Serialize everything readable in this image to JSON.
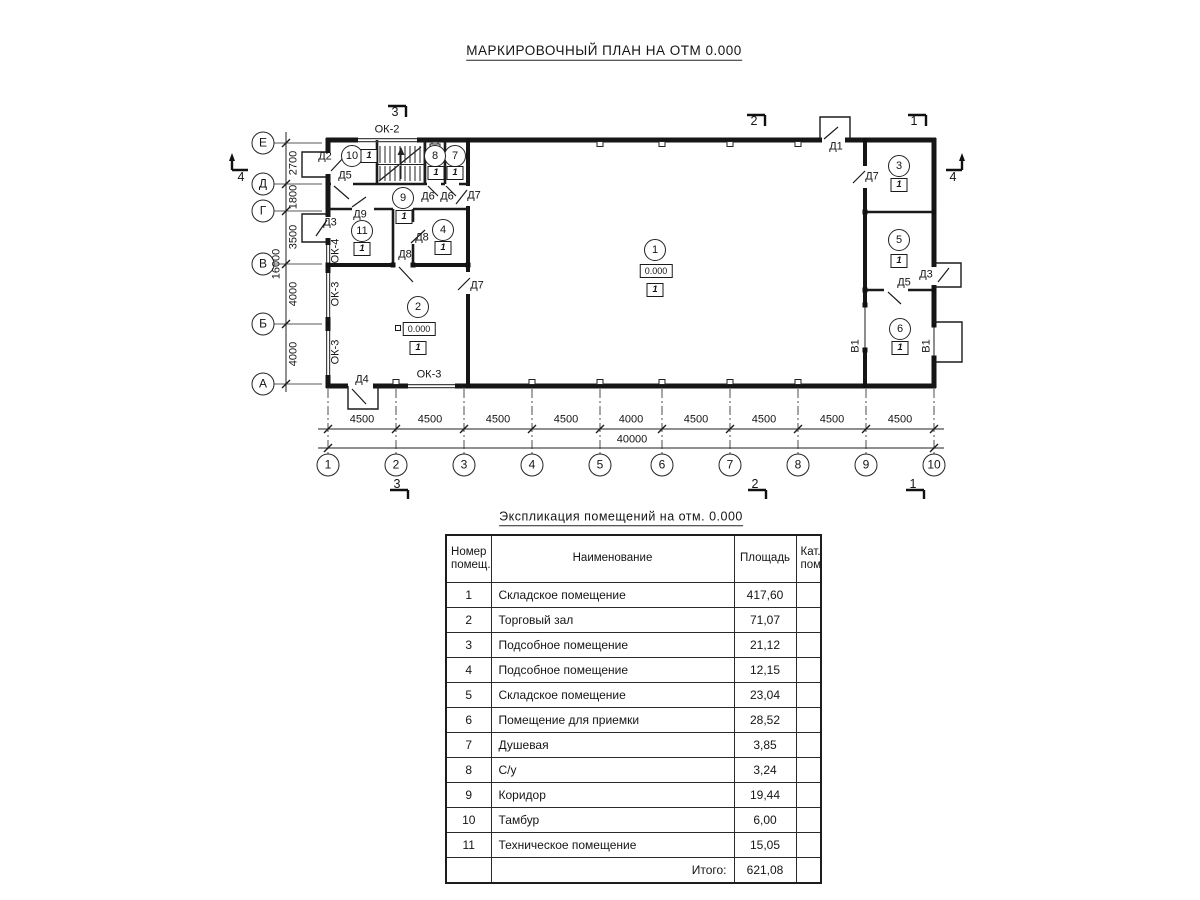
{
  "titles": {
    "plan": "МАРКИРОВОЧНЫЙ ПЛАН НА ОТМ 0.000",
    "table": "Экспликация помещений на отм. 0.000"
  },
  "axes": {
    "cols": [
      "1",
      "2",
      "3",
      "4",
      "5",
      "6",
      "7",
      "8",
      "9",
      "10"
    ],
    "rows": [
      "Е",
      "Д",
      "Г",
      "В",
      "Б",
      "А"
    ]
  },
  "dims": {
    "col_segments": [
      "4500",
      "4500",
      "4500",
      "4500",
      "4000",
      "4500",
      "4500",
      "4500",
      "4500"
    ],
    "col_total": "40000",
    "row_segments": [
      "2700",
      "1800",
      "3500",
      "4000",
      "4000"
    ],
    "row_total": "16000"
  },
  "sections": {
    "top": [
      "3",
      "2",
      "1"
    ],
    "bottom": [
      "3",
      "2",
      "1"
    ],
    "left": "4",
    "right": "4"
  },
  "doors": [
    "Д2",
    "Д5",
    "Д9",
    "Д3",
    "Д8",
    "Д8",
    "Д7",
    "Д4",
    "Д6",
    "Д6",
    "Д7",
    "Д1",
    "Д7",
    "Д3",
    "Д5"
  ],
  "gates": [
    "В1",
    "В1"
  ],
  "windows": [
    "ОК-2",
    "ОК-4",
    "ОК-3",
    "ОК-3",
    "ОК-3"
  ],
  "rooms": [
    {
      "num": "1",
      "marker": "1",
      "elevation": "0.000"
    },
    {
      "num": "2",
      "marker": "1",
      "elevation": "0.000"
    },
    {
      "num": "3",
      "marker": "1"
    },
    {
      "num": "4",
      "marker": "1"
    },
    {
      "num": "5",
      "marker": "1"
    },
    {
      "num": "6",
      "marker": "1"
    },
    {
      "num": "7",
      "marker": "1"
    },
    {
      "num": "8",
      "marker": "1"
    },
    {
      "num": "9",
      "marker": "1"
    },
    {
      "num": "10",
      "marker": "1"
    },
    {
      "num": "11",
      "marker": "1"
    }
  ],
  "table": {
    "headers": {
      "num": "Номер помещ.",
      "name": "Наименование",
      "area": "Площадь",
      "cat": "Кат. пом."
    },
    "rows": [
      {
        "num": "1",
        "name": "Складское помещение",
        "area": "417,60",
        "cat": ""
      },
      {
        "num": "2",
        "name": "Торговый зал",
        "area": "71,07",
        "cat": ""
      },
      {
        "num": "3",
        "name": "Подсобное помещение",
        "area": "21,12",
        "cat": ""
      },
      {
        "num": "4",
        "name": "Подсобное помещение",
        "area": "12,15",
        "cat": ""
      },
      {
        "num": "5",
        "name": "Складское помещение",
        "area": "23,04",
        "cat": ""
      },
      {
        "num": "6",
        "name": "Помещение для приемки",
        "area": "28,52",
        "cat": ""
      },
      {
        "num": "7",
        "name": "Душевая",
        "area": "3,85",
        "cat": ""
      },
      {
        "num": "8",
        "name": "С/у",
        "area": "3,24",
        "cat": ""
      },
      {
        "num": "9",
        "name": "Коридор",
        "area": "19,44",
        "cat": ""
      },
      {
        "num": "10",
        "name": "Тамбур",
        "area": "6,00",
        "cat": ""
      },
      {
        "num": "11",
        "name": "Техническое помещение",
        "area": "15,05",
        "cat": ""
      }
    ],
    "total_label": "Итого:",
    "total_area": "621,08"
  }
}
